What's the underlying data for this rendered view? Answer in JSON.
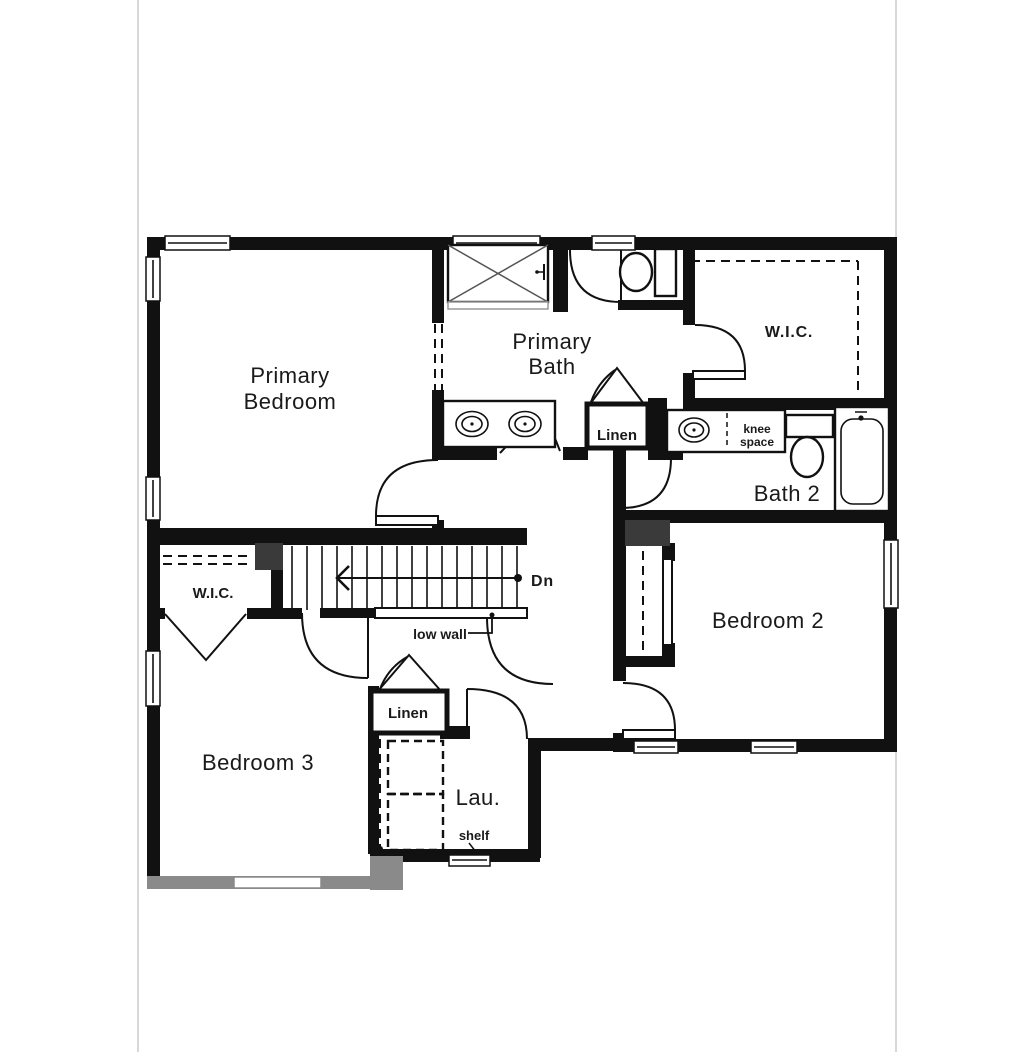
{
  "page": {
    "background": "#ffffff",
    "panel_border": "#d8d8d8"
  },
  "plan": {
    "colors": {
      "wall": "#111111",
      "gray_wall": "#8a8a8a",
      "dark_block": "#3a3a3a",
      "text": "#1a1a1a"
    },
    "rooms": {
      "primary_bedroom": {
        "line1": "Primary",
        "line2": "Bedroom"
      },
      "primary_bath": {
        "line1": "Primary",
        "line2": "Bath"
      },
      "wic_right": {
        "label": "W.I.C."
      },
      "wic_left": {
        "label": "W.I.C."
      },
      "bath_2": {
        "label": "Bath 2"
      },
      "bedroom_2": {
        "label": "Bedroom 2"
      },
      "bedroom_3": {
        "label": "Bedroom 3"
      },
      "laundry": {
        "label": "Lau."
      }
    },
    "closets": {
      "linen_upper": "Linen",
      "linen_lower": "Linen"
    },
    "annotations": {
      "knee_line1": "knee",
      "knee_line2": "space",
      "stairs_down": "Dn",
      "low_wall": "low wall",
      "shelf": "shelf"
    }
  }
}
